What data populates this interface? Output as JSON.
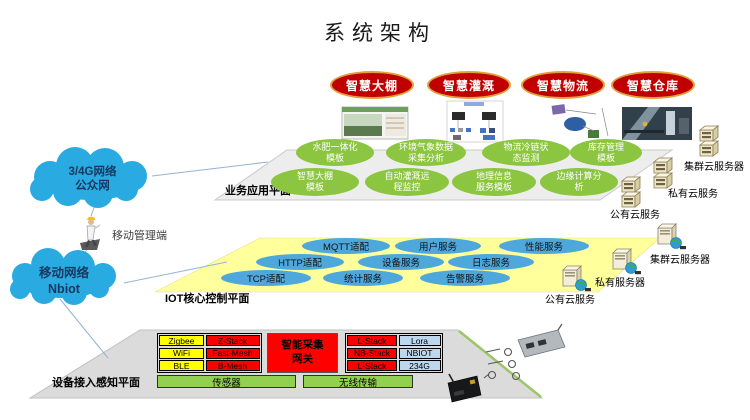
{
  "title": "系统架构",
  "top_apps": [
    "智慧大棚",
    "智慧灌溉",
    "智慧物流",
    "智慧仓库"
  ],
  "clouds": {
    "public_net": "3/4G网络\n公众网",
    "nbiot": "移动网络\nNbiot"
  },
  "mobile_terminal": "移动管理端",
  "app_layer": {
    "label": "业务应用平面",
    "row1": [
      "水肥一体化\n模板",
      "环境气象数据\n采集分析",
      "物流冷链状\n态监测",
      "库存管理\n模板"
    ],
    "row2": [
      "智慧大棚\n模板",
      "自动灌溉远\n程监控",
      "地理信息\n服务模板",
      "边缘计算分\n析"
    ],
    "servers": [
      "集群云服务器",
      "私有云服务",
      "公有云服务"
    ]
  },
  "iot_layer": {
    "label": "IOT核心控制平面",
    "row1": [
      "MQTT适配",
      "用户服务",
      "性能服务"
    ],
    "row2": [
      "HTTP适配",
      "设备服务",
      "日志服务"
    ],
    "row3": [
      "TCP适配",
      "统计服务",
      "告警服务"
    ],
    "servers": [
      "集群云服务器",
      "私有服务器",
      "公有云服务"
    ]
  },
  "device_layer": {
    "label": "设备接入感知平面",
    "protocol_table": {
      "rows": [
        [
          "Zigbee",
          "Z-Stack"
        ],
        [
          "WiFi",
          "Fast-Mesh"
        ],
        [
          "BLE",
          "B-Mesh"
        ]
      ]
    },
    "gateway": "智能采集\n网关",
    "wireless_table": {
      "rows": [
        [
          "L-Stack",
          "Lora"
        ],
        [
          "NB-Stack",
          "NBIOT"
        ],
        [
          "L-Stack",
          "234G"
        ]
      ]
    },
    "bars": [
      "传感器",
      "无线传输"
    ]
  },
  "colors": {
    "app_oval": "#C00000",
    "oval_border": "#E0A13C",
    "green_oval": "#8CC540",
    "blue_oval": "#4FA8DC",
    "cloud": "#29ABE2",
    "yellow_layer": "#FFFF9C",
    "gray_layer": "#EDEDED",
    "red_cell": "#FF0000",
    "yellow_cell": "#FFFF00",
    "blue_cell": "#BDD7EE",
    "green_bar": "#92D050"
  }
}
